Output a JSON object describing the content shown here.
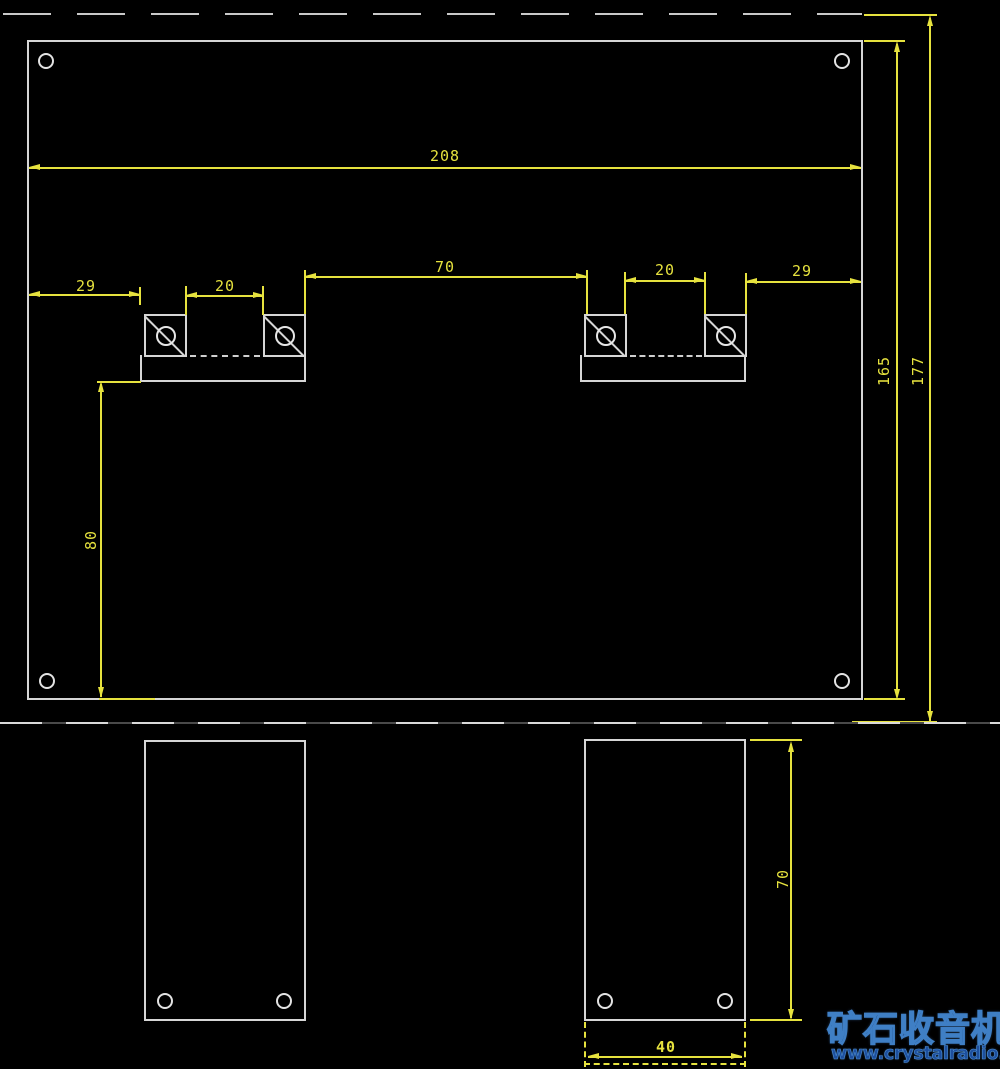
{
  "drawing": {
    "type": "CAD mechanical drawing, chassis panel front view with two foot side views",
    "colors": {
      "background": "#000000",
      "outline": "#d6d6d6",
      "dimension": "#e6e23e",
      "watermark_fill": "#12346a",
      "watermark_url": "#1d4f9e"
    },
    "dimensions": {
      "panel_width": "208",
      "left_edge_to_bracket": "29",
      "left_bracket_gap": "20",
      "center_span": "70",
      "right_bracket_gap": "20",
      "bracket_to_right_edge": "29",
      "panel_height": "165",
      "overall_height": "177",
      "bracket_to_bottom": "80",
      "foot_height": "70",
      "foot_width": "40"
    },
    "watermark": {
      "name": "矿石收音机",
      "url": "www.crystalradio.cn"
    }
  }
}
